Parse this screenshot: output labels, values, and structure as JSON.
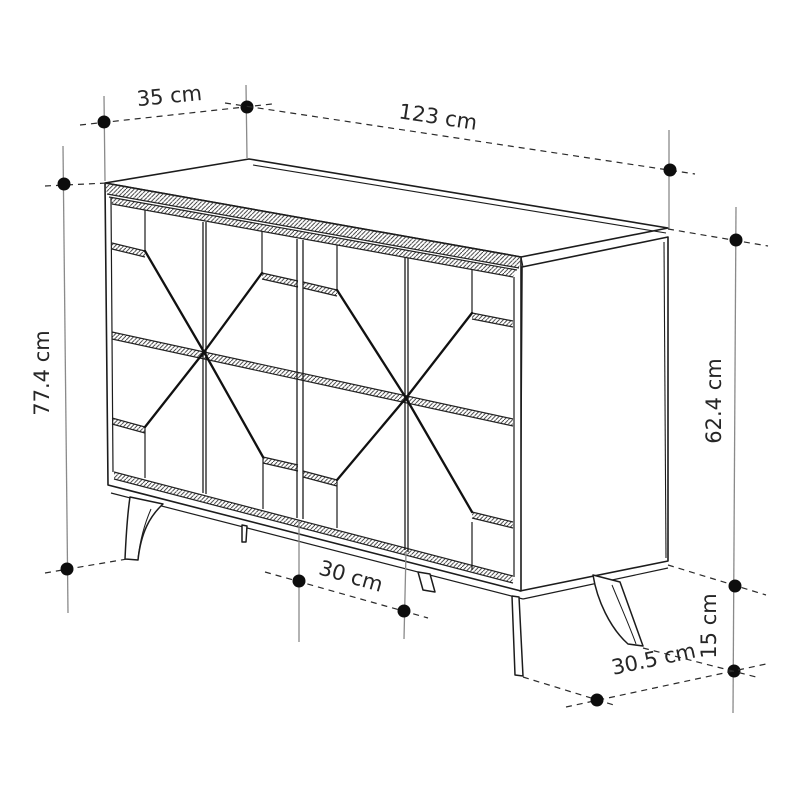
{
  "diagram": {
    "background_color": "#ffffff",
    "line_color": "#1c1c1c",
    "dimension_axis_color": "#8a8a8a",
    "dimension_dash_color": "#2b2b2b",
    "dot_color": "#0d0d0d",
    "text_color": "#262626",
    "dimensions": {
      "depth": "35 cm",
      "width": "123 cm",
      "total_height": "77.4 cm",
      "body_height": "62.4 cm",
      "door_spacing": "30 cm",
      "leg_height": "15 cm",
      "leg_depth_spacing": "30.5 cm"
    }
  }
}
